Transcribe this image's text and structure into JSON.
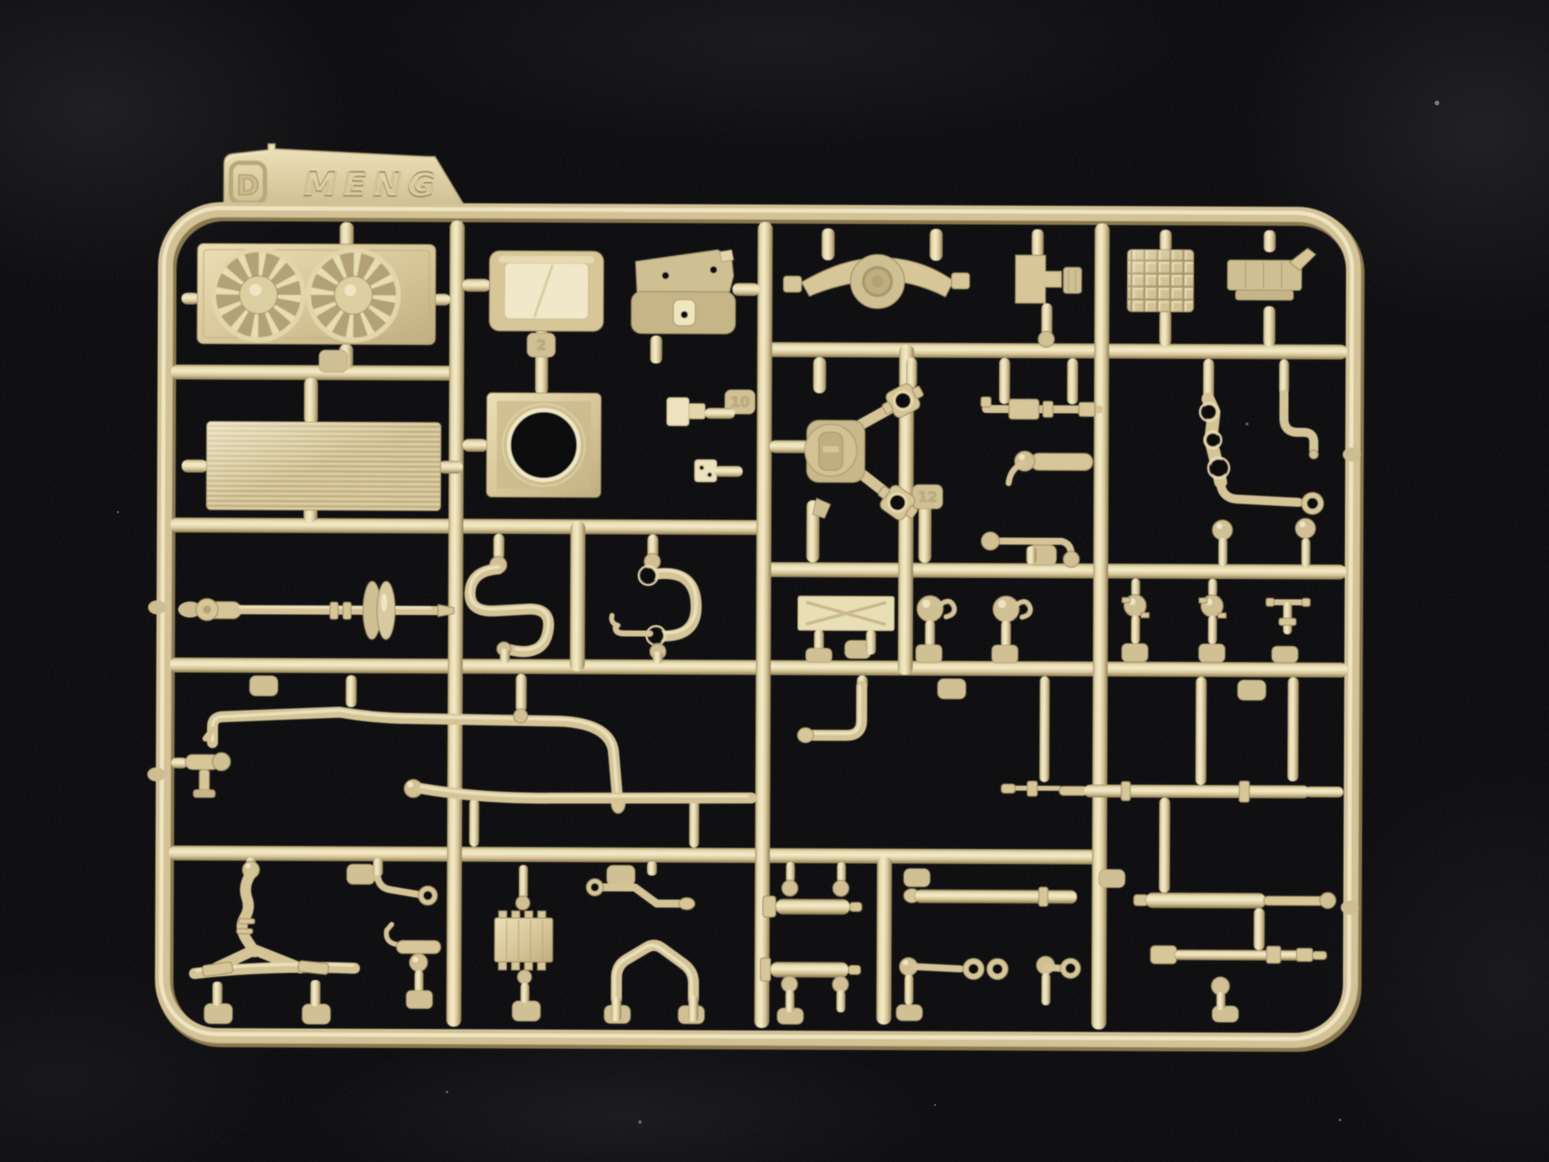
{
  "scene": {
    "description": "Photograph of an injection-moulded model kit sprue (runner) of sand-tan plastic parts laid on black fabric",
    "colors": {
      "background": "#0a0a0c",
      "plastic_mid": "#d6c698",
      "plastic_highlight": "#f4ecca",
      "plastic_shadow": "#9d8c60",
      "tab_face": "#ddd0a6"
    }
  },
  "sprue": {
    "letter": "D",
    "brand": "MENG",
    "visible_part_numbers": [
      "2",
      "10",
      "12"
    ],
    "parts": [
      {
        "name": "twin-cooling-fans",
        "description": "Two twelve-blade cooling fans in a rectangular shroud plate"
      },
      {
        "name": "radiator-panel",
        "description": "Finely ribbed rectangular radiator core"
      },
      {
        "name": "windshield-frame",
        "description": "Rounded rectangular windshield frame"
      },
      {
        "name": "commander-cupola",
        "description": "Rounded cupola base with locating holes"
      },
      {
        "name": "axle-housing",
        "description": "Axle beam with large central hub ring"
      },
      {
        "name": "coupling-bracket",
        "description": "Small U-shaped coupling bracket with ribbed block"
      },
      {
        "name": "waffle-tread-block",
        "description": "Square block with waffle grid texture"
      },
      {
        "name": "stowage-box-bracket",
        "description": "Grooved bracket with angled arm"
      },
      {
        "name": "hatch-ring-plate",
        "description": "Square plate with large circular hatch opening"
      },
      {
        "name": "small-hinge-clips",
        "description": "Two small hinge clip pieces"
      },
      {
        "name": "transfer-case-with-drive-shafts",
        "description": "Transfer case body with two universal-joint drive shafts"
      },
      {
        "name": "pipe-tee-fitting",
        "description": "Horizontal pipe with block fittings"
      },
      {
        "name": "ball-joint-cylinder",
        "description": "Short cylinder with ball joint and bent arm"
      },
      {
        "name": "hole-strap-linkage",
        "description": "Strap with three holes, arm ending in a ring eye"
      },
      {
        "name": "faucet-elbow-pipe",
        "description": "Downward elbow pipe like a tap spout"
      },
      {
        "name": "drive-shaft-with-coupling",
        "description": "Long drive shaft with double-disc coupling"
      },
      {
        "name": "s-bend-pipe",
        "description": "S-curved hose with ball end"
      },
      {
        "name": "c-hook-bracket",
        "description": "C-shaped bracket with eye holes and hook tail"
      },
      {
        "name": "x-braced-plate",
        "description": "Flat rectangular plate with X bracing"
      },
      {
        "name": "ball-hook-joints",
        "description": "Two ball joints with side hook eyes"
      },
      {
        "name": "ball-stud-pins",
        "description": "Two vertical pins with centre balls and fins"
      },
      {
        "name": "valve-tap",
        "description": "T-handled valve stem"
      },
      {
        "name": "flanged-fitting",
        "description": "Small flanged cylinder fitting at frame edge"
      },
      {
        "name": "hooked-fuel-line",
        "description": "Long pipe with hooked end and sweeping elbow"
      },
      {
        "name": "long-fuel-line",
        "description": "Long shallow-curved pipe with ball socket end"
      },
      {
        "name": "l-bend-pipe",
        "description": "Vertical pipe with 90-degree elbow"
      },
      {
        "name": "coupler-rod",
        "description": "Thin rod with coupling sleeve"
      },
      {
        "name": "barrel-rod-with-collars",
        "description": "Long cylindrical rod with collar rings"
      },
      {
        "name": "telescopic-cylinder-upper",
        "description": "Telescopic cylinder with thin extension rod"
      },
      {
        "name": "telescopic-cylinder-lower",
        "description": "Telescopic cylinder with end fittings"
      },
      {
        "name": "exhaust-y-pipe",
        "description": "Y-branched exhaust pipe on a header bar with feet"
      },
      {
        "name": "ring-end-lever",
        "description": "Short lever ending in a ring eye"
      },
      {
        "name": "primer-pump",
        "description": "Small pump with hook, cylinder and ball"
      },
      {
        "name": "ribbed-manifold-block",
        "description": "Toothed manifold block"
      },
      {
        "name": "bent-control-arm",
        "description": "Z-bent arm with ring at one end"
      },
      {
        "name": "arch-pipe-bracket",
        "description": "Arch / tent shaped pipe bracket"
      },
      {
        "name": "piston-cylinders-pair",
        "description": "Two short cylinders with ball-top pins"
      },
      {
        "name": "double-ring-links",
        "description": "Links with paired ring eyes and ball ends"
      },
      {
        "name": "push-rod",
        "description": "Plain straight push rod"
      }
    ]
  }
}
